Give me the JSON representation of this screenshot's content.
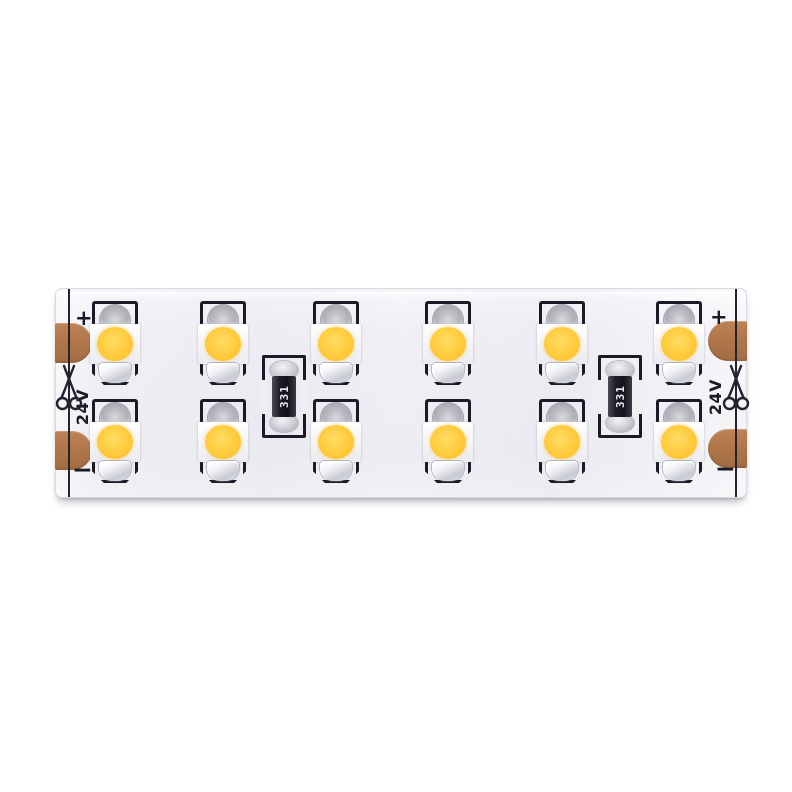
{
  "product": {
    "description": "White rigid dual-row LED strip segment with twelve warm-white SMD LEDs, two current-limiting resistors, copper solder pads and cut marks at both ends",
    "voltage_label": "24V",
    "polarity_positive": "+",
    "polarity_negative": "−",
    "resistor_code": "331",
    "led_count": 12,
    "led_rows": 2,
    "led_columns": 6,
    "resistor_count": 2
  },
  "colors": {
    "background": "#ffffff",
    "pcb_white": "#efeef3",
    "silkscreen_black": "#1b1a26",
    "phosphor_yellow": "#fdc634",
    "copper_pad_brown": "#b1774b",
    "solder_silver": "#c8cad2",
    "resistor_body_black": "#1e1d28"
  },
  "icons": {
    "scissors": "scissors-cut-mark-icon"
  }
}
